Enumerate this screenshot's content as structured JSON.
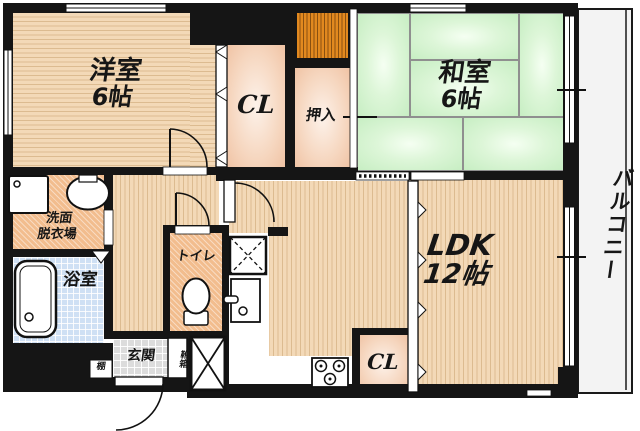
{
  "meta": {
    "type": "apartment-floor-plan"
  },
  "rooms": {
    "western": {
      "name": "洋室",
      "size": "6帖"
    },
    "japanese": {
      "name": "和室",
      "size": "6帖"
    },
    "ldk": {
      "name": "LDK",
      "size": "12帖"
    },
    "closet_upper": {
      "name": "CL"
    },
    "closet_lower": {
      "name": "CL"
    },
    "oshiire": {
      "name": "押入"
    },
    "washroom": {
      "name_line1": "洗面",
      "name_line2": "脱衣場"
    },
    "bathroom": {
      "name": "浴室"
    },
    "toilet": {
      "name": "トイレ"
    },
    "entrance": {
      "name": "玄関"
    },
    "shoebox": {
      "name": "靴箱"
    },
    "shelf": {
      "name": "棚"
    },
    "balcony": {
      "name": "バルコニー"
    }
  },
  "colors": {
    "wall": "#151515",
    "flooring_base": "#f3d9b7",
    "flooring_stripe": "#dcbb90",
    "tatami_edge": "#c7eec3",
    "tatami_center": "#f5fff2",
    "closet_center": "#fdf2ea",
    "closet_edge": "#f0c3a4",
    "sanitary_orange": "#f2bd8e",
    "bathroom_blue": "#cfe0f4",
    "entrance_gray": "#dcdcdc",
    "balcony_gray": "#f3f3f3",
    "duct_orange": "#e2891f"
  }
}
